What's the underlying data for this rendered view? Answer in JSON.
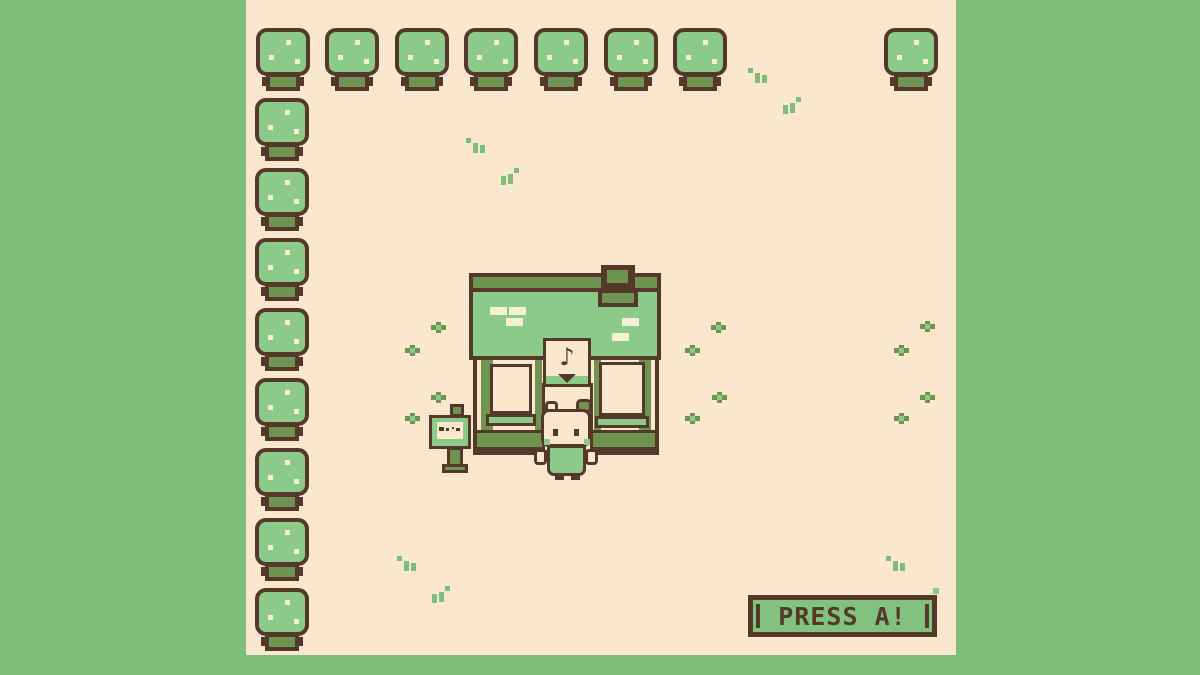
{
  "hud": {
    "press_button_label": "PRESS A!"
  },
  "shop": {
    "banner_note_icon": "♪"
  },
  "palette": {
    "background_green": "#7DBE7A",
    "ground_cream": "#FBE6CE",
    "foliage_green": "#8BCA88",
    "outline_brown": "#54392B",
    "olive_green": "#6F9350",
    "speck_cream": "#F5F0D1",
    "prompt_fill_green": "#82C27E"
  },
  "scene": {
    "trees": [
      [
        10,
        28
      ],
      [
        79,
        28
      ],
      [
        149,
        28
      ],
      [
        218,
        28
      ],
      [
        288,
        28
      ],
      [
        358,
        28
      ],
      [
        427,
        28
      ],
      [
        638,
        28
      ],
      [
        9,
        98
      ],
      [
        9,
        168
      ],
      [
        9,
        238
      ],
      [
        9,
        308
      ],
      [
        9,
        378
      ],
      [
        9,
        448
      ],
      [
        9,
        518
      ],
      [
        9,
        588
      ]
    ],
    "flowers": [
      [
        185,
        322
      ],
      [
        159,
        345
      ],
      [
        185,
        392
      ],
      [
        159,
        413
      ],
      [
        465,
        322
      ],
      [
        439,
        345
      ],
      [
        466,
        392
      ],
      [
        439,
        413
      ],
      [
        674,
        321
      ],
      [
        648,
        345
      ],
      [
        674,
        392
      ],
      [
        648,
        413
      ]
    ],
    "grass": [
      {
        "x": 502,
        "y": 68,
        "variant": "a"
      },
      {
        "x": 537,
        "y": 97,
        "variant": "b"
      },
      {
        "x": 220,
        "y": 138,
        "variant": "a"
      },
      {
        "x": 255,
        "y": 168,
        "variant": "b"
      },
      {
        "x": 151,
        "y": 556,
        "variant": "a"
      },
      {
        "x": 186,
        "y": 586,
        "variant": "b"
      },
      {
        "x": 640,
        "y": 556,
        "variant": "a"
      }
    ]
  }
}
